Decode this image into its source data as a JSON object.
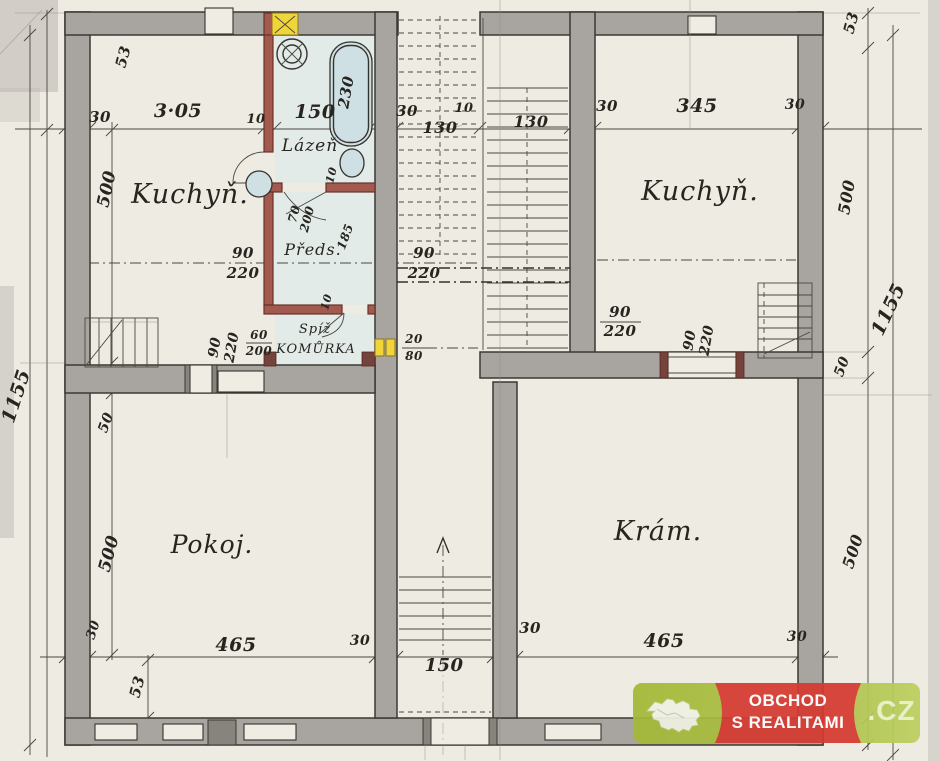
{
  "logo": {
    "line1": "OBCHOD",
    "line2": "S REALITAMI",
    "tld": ".CZ"
  },
  "colors": {
    "paper": "#eeebe3",
    "wall_gray": "#a8a5a0",
    "partition_red": "#a25a4e",
    "fixture_blue": "#cfe0e5",
    "flue_yellow": "#efd53a",
    "ink": "#35332d",
    "logo_green": "#a9bf3e",
    "logo_red": "#d63a31"
  },
  "annotations": {
    "rooms": [
      {
        "name": "room-label-kuchyn-left",
        "text": "Kuchyň.",
        "x": 190,
        "y": 203,
        "size": 27
      },
      {
        "name": "room-label-lazen",
        "text": "Lázeň",
        "x": 310,
        "y": 151,
        "size": 17
      },
      {
        "name": "room-label-kuchyn-right",
        "text": "Kuchyň.",
        "x": 700,
        "y": 200,
        "size": 27
      },
      {
        "name": "room-label-preds",
        "text": "Předs.",
        "x": 313,
        "y": 255,
        "size": 16
      },
      {
        "name": "room-label-spiz",
        "text": "Spíž",
        "x": 315,
        "y": 333,
        "size": 13
      },
      {
        "name": "room-label-komurka",
        "text": "KOMŮRKA",
        "x": 316,
        "y": 353,
        "size": 13
      },
      {
        "name": "room-label-pokoj",
        "text": "Pokoj.",
        "x": 212,
        "y": 553,
        "size": 25
      },
      {
        "name": "room-label-kram",
        "text": "Krám.",
        "x": 658,
        "y": 540,
        "size": 27
      }
    ],
    "dimensions": [
      {
        "text": "30",
        "x": 100,
        "y": 122,
        "size": 15
      },
      {
        "text": "3·05",
        "x": 178,
        "y": 117,
        "size": 19
      },
      {
        "text": "10",
        "x": 256,
        "y": 123,
        "size": 13
      },
      {
        "text": "150",
        "x": 315,
        "y": 118,
        "size": 19
      },
      {
        "text": "30",
        "x": 407,
        "y": 116,
        "size": 15
      },
      {
        "text": "10",
        "x": 464,
        "y": 112,
        "size": 13
      },
      {
        "text": "130",
        "x": 440,
        "y": 133,
        "size": 16
      },
      {
        "text": "130",
        "x": 531,
        "y": 127,
        "size": 16
      },
      {
        "text": "30",
        "x": 607,
        "y": 111,
        "size": 15
      },
      {
        "text": "345",
        "x": 697,
        "y": 112,
        "size": 19
      },
      {
        "text": "30",
        "x": 795,
        "y": 109,
        "size": 14
      },
      {
        "text": "53",
        "x": 128,
        "y": 58,
        "size": 15,
        "rot": -75
      },
      {
        "text": "53",
        "x": 856,
        "y": 24,
        "size": 15,
        "rot": -75
      },
      {
        "text": "53",
        "x": 142,
        "y": 688,
        "size": 15,
        "rot": -75
      },
      {
        "text": "500",
        "x": 112,
        "y": 190,
        "size": 17,
        "rot": -78
      },
      {
        "text": "1155",
        "x": 22,
        "y": 398,
        "size": 19,
        "rot": -72
      },
      {
        "text": "1155",
        "x": 894,
        "y": 312,
        "size": 19,
        "rot": -65
      },
      {
        "text": "500",
        "x": 852,
        "y": 198,
        "size": 16,
        "rot": -80
      },
      {
        "text": "50",
        "x": 846,
        "y": 368,
        "size": 14,
        "rot": -70
      },
      {
        "text": "500",
        "x": 858,
        "y": 553,
        "size": 16,
        "rot": -72
      },
      {
        "text": "50",
        "x": 110,
        "y": 424,
        "size": 14,
        "rot": -70
      },
      {
        "text": "500",
        "x": 114,
        "y": 555,
        "size": 17,
        "rot": -75
      },
      {
        "text": "30",
        "x": 97,
        "y": 631,
        "size": 13,
        "rot": -72
      },
      {
        "text": "90",
        "x": 243,
        "y": 258,
        "size": 15
      },
      {
        "text": "220",
        "x": 243,
        "y": 278,
        "size": 15
      },
      {
        "text": "90",
        "x": 424,
        "y": 258,
        "size": 15
      },
      {
        "text": "220",
        "x": 424,
        "y": 278,
        "size": 15
      },
      {
        "text": "90",
        "x": 219,
        "y": 348,
        "size": 14,
        "rot": -80
      },
      {
        "text": "220",
        "x": 236,
        "y": 348,
        "size": 14,
        "rot": -80
      },
      {
        "text": "60",
        "x": 259,
        "y": 339,
        "size": 12
      },
      {
        "text": "200",
        "x": 259,
        "y": 355,
        "size": 12
      },
      {
        "text": "20",
        "x": 414,
        "y": 343,
        "size": 12
      },
      {
        "text": "80",
        "x": 414,
        "y": 360,
        "size": 12
      },
      {
        "text": "230",
        "x": 351,
        "y": 93,
        "size": 15,
        "rot": -80
      },
      {
        "text": "10",
        "x": 335,
        "y": 176,
        "size": 11,
        "rot": -75
      },
      {
        "text": "70",
        "x": 298,
        "y": 215,
        "size": 12,
        "rot": -75
      },
      {
        "text": "200",
        "x": 311,
        "y": 220,
        "size": 12,
        "rot": -75
      },
      {
        "text": "185",
        "x": 349,
        "y": 238,
        "size": 12,
        "rot": -70
      },
      {
        "text": "10",
        "x": 330,
        "y": 303,
        "size": 11,
        "rot": -75
      },
      {
        "text": "90",
        "x": 620,
        "y": 317,
        "size": 15
      },
      {
        "text": "220",
        "x": 620,
        "y": 336,
        "size": 15
      },
      {
        "text": "90",
        "x": 694,
        "y": 341,
        "size": 14,
        "rot": -80
      },
      {
        "text": "220",
        "x": 711,
        "y": 341,
        "size": 14,
        "rot": -80
      },
      {
        "text": "465",
        "x": 236,
        "y": 651,
        "size": 19
      },
      {
        "text": "30",
        "x": 360,
        "y": 645,
        "size": 14
      },
      {
        "text": "150",
        "x": 444,
        "y": 671,
        "size": 18
      },
      {
        "text": "30",
        "x": 530,
        "y": 633,
        "size": 15
      },
      {
        "text": "465",
        "x": 664,
        "y": 647,
        "size": 19
      },
      {
        "text": "30",
        "x": 797,
        "y": 641,
        "size": 14
      }
    ]
  }
}
